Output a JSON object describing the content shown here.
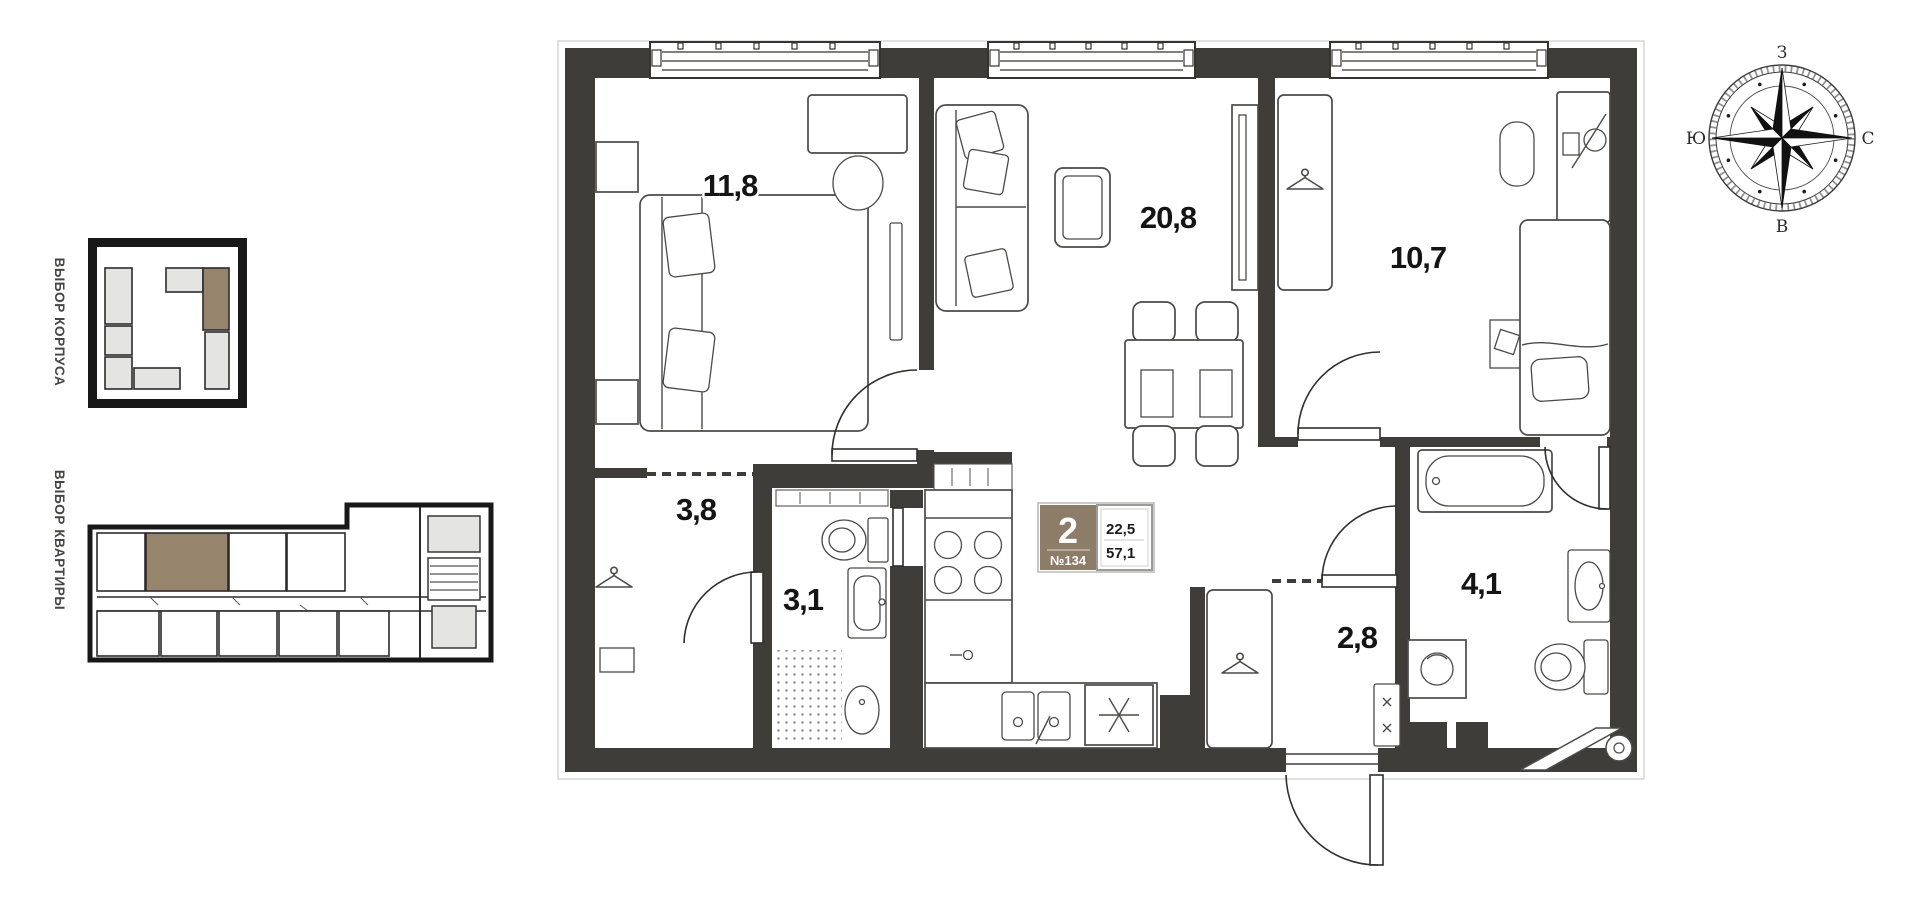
{
  "sidebar": {
    "corpus_selector_label": "ВЫБОР КОРПУСА",
    "apartment_selector_label": "ВЫБОР КВАРТИРЫ"
  },
  "apartment": {
    "rooms_count": "2",
    "number_label": "№134",
    "area_living": "22,5",
    "area_total": "57,1"
  },
  "room_areas": {
    "bedroom_main": "11,8",
    "living_kitchen": "20,8",
    "bedroom_second": "10,7",
    "wardrobe": "3,8",
    "bathroom_guest": "3,1",
    "hallway": "2,8",
    "bathroom_main": "4,1"
  },
  "compass": {
    "west": "З",
    "south": "Ю",
    "north": "С",
    "east": "В"
  },
  "icons": [
    "hanger-icon",
    "compass-rose",
    "stove-burners-icon",
    "freezer-asterisk-icon",
    "shower-drain-icon"
  ],
  "colors": {
    "wall": "#3e3d3a",
    "selection_brown": "#97846d",
    "badge_brown": "#8d7c68",
    "block_grey": "#e4e4e2"
  }
}
